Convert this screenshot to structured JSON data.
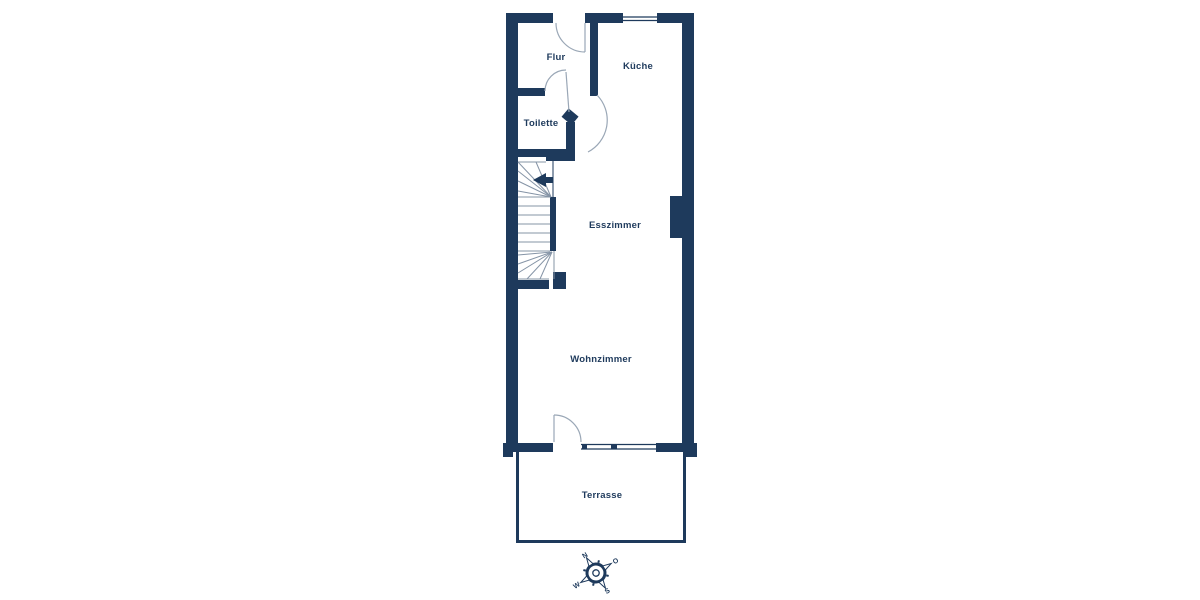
{
  "floorplan": {
    "title": "Grundriss Erdgeschoss",
    "rooms": [
      {
        "id": "flur",
        "label": "Flur"
      },
      {
        "id": "kueche",
        "label": "Küche"
      },
      {
        "id": "toilette",
        "label": "Toilette"
      },
      {
        "id": "esszimmer",
        "label": "Esszimmer"
      },
      {
        "id": "wohnzimmer",
        "label": "Wohnzimmer"
      },
      {
        "id": "terrasse",
        "label": "Terrasse"
      }
    ],
    "compass": {
      "north": "N",
      "east": "O",
      "south": "S",
      "west": "W",
      "rotation_deg": -32
    },
    "colors": {
      "wall": "#1e3a5c",
      "door_arc": "#9aa7b6",
      "stair_line": "#8594a6",
      "background": "#ffffff"
    }
  }
}
